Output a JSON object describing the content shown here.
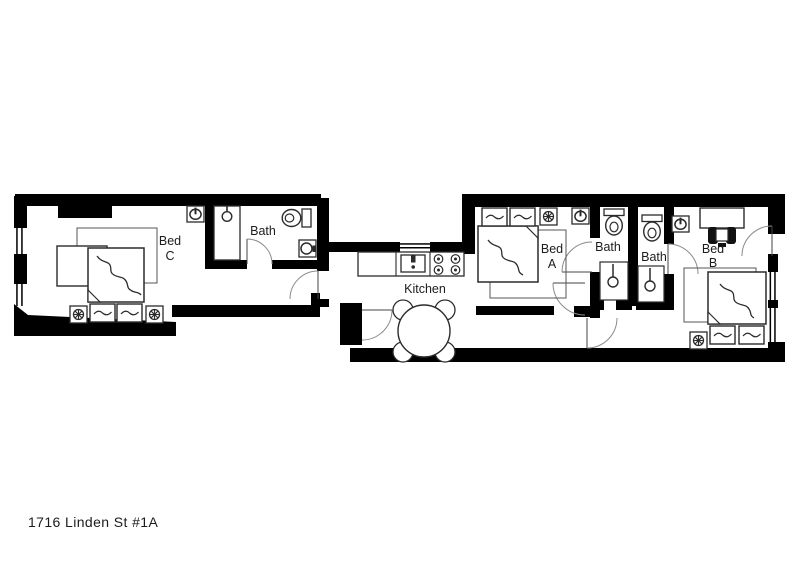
{
  "title": "1716 Linden St #1A",
  "rooms": {
    "bed_c": {
      "line1": "Bed",
      "line2": "C"
    },
    "bath_1": {
      "label": "Bath"
    },
    "kitchen": {
      "label": "Kitchen"
    },
    "bed_a": {
      "line1": "Bed",
      "line2": "A"
    },
    "bath_2": {
      "label": "Bath"
    },
    "bath_3": {
      "label": "Bath"
    },
    "bed_b": {
      "line1": "Bed",
      "line2": "B"
    }
  },
  "fixtures": {
    "bed_c": [
      "double-bed",
      "two-pillows",
      "nightstand-lamp",
      "nightstand-lamp",
      "rug",
      "desk",
      "office-chair",
      "wall-light"
    ],
    "bath_1": [
      "shower-stall",
      "shower-head",
      "toilet",
      "pedestal-sink",
      "door-swing"
    ],
    "kitchen": [
      "counter",
      "kitchen-sink",
      "stove-4-burner",
      "round-dining-table",
      "four-chairs",
      "window",
      "entry-door-swing"
    ],
    "bed_a": [
      "double-bed",
      "two-pillows",
      "nightstand-lamp",
      "wall-light",
      "rug",
      "door-swing"
    ],
    "bath_2": [
      "toilet",
      "shower-stall",
      "shower-head",
      "door-swing"
    ],
    "bath_3": [
      "toilet",
      "shower-stall",
      "shower-head",
      "door-swing"
    ],
    "bed_b": [
      "double-bed",
      "two-pillows",
      "nightstand-lamp",
      "desk",
      "desk-chair",
      "wall-light",
      "rug",
      "door-swing",
      "windows"
    ]
  },
  "colors": {
    "wall": "#000000",
    "furniture_line": "#2b2b2b",
    "door_arc": "#8a8a8a",
    "background": "#ffffff",
    "text": "#1c1c1c"
  }
}
